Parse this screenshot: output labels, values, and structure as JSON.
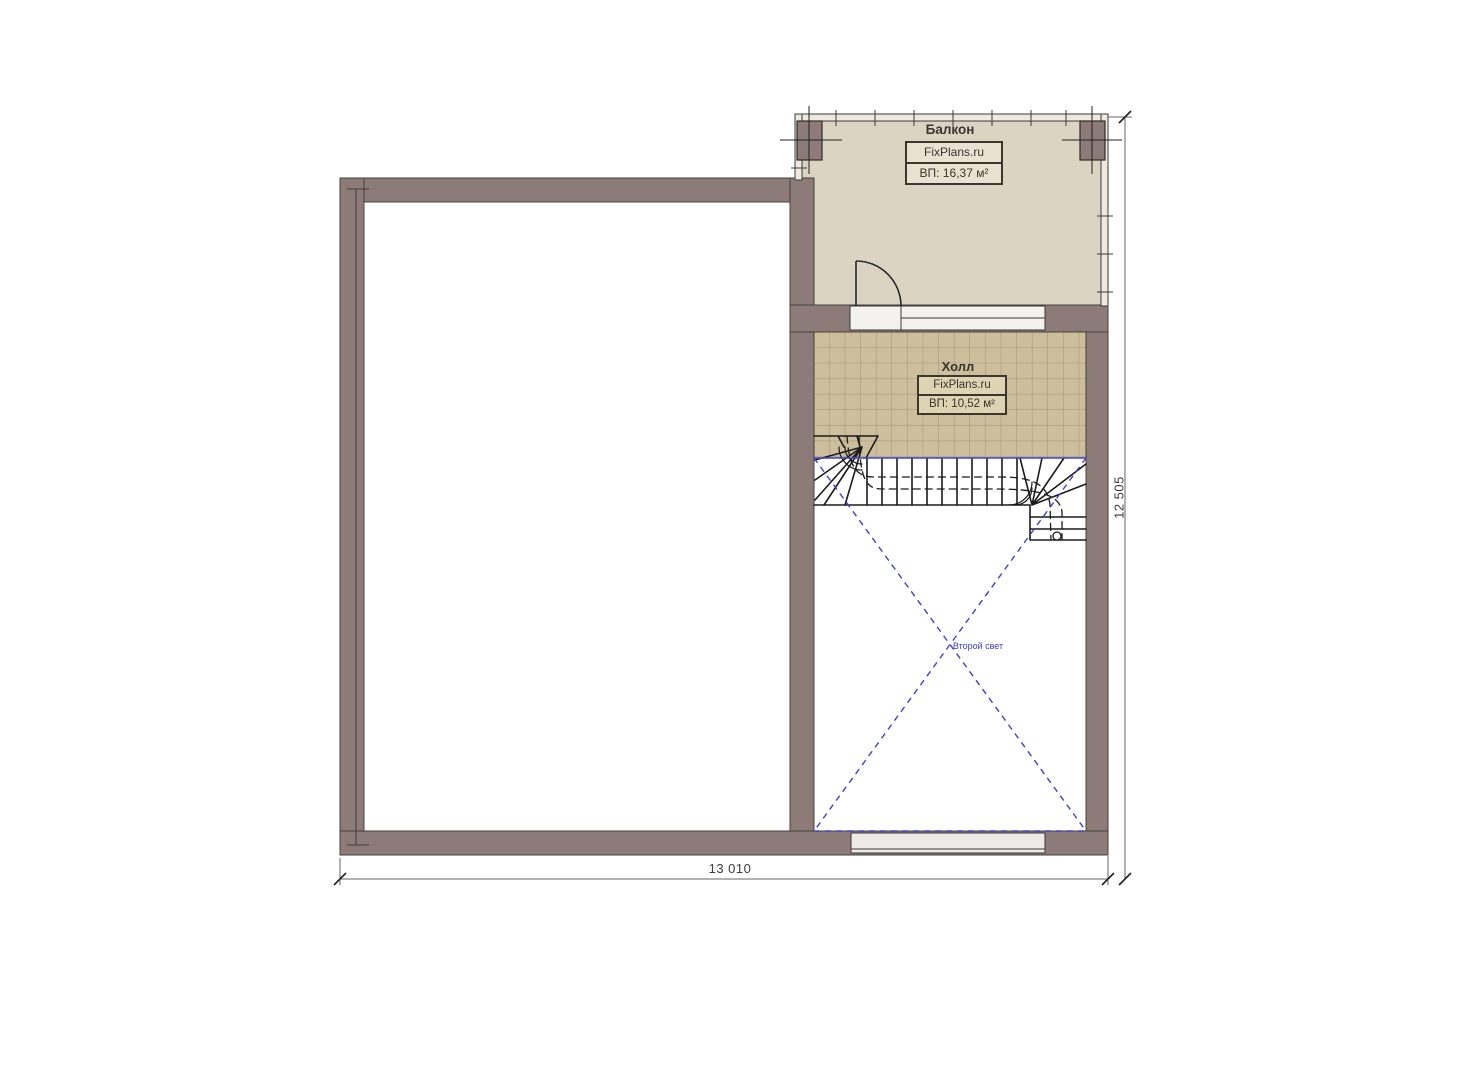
{
  "plan": {
    "rooms": {
      "balcony": {
        "title": "Балкон",
        "brand": "FixPlans.ru",
        "area": "ВП: 16,37 м²"
      },
      "hall": {
        "title": "Холл",
        "brand": "FixPlans.ru",
        "area": "ВП: 10,52 м²"
      }
    },
    "void_label": "Второй свет",
    "dimensions": {
      "width_mm": "13 010",
      "height_mm": "12 505"
    },
    "colors": {
      "wall": "#8c7b79",
      "wall_edge": "#45403c",
      "balcony_floor": "#dcd4c3",
      "tile_floor": "#cdbf9c",
      "tile_grid": "#a1937a",
      "stair_line": "#1c1c1c",
      "accent_blue": "#4040cc",
      "dimension_line": "#666666",
      "info_box_fill": "#e9e2d1"
    }
  }
}
